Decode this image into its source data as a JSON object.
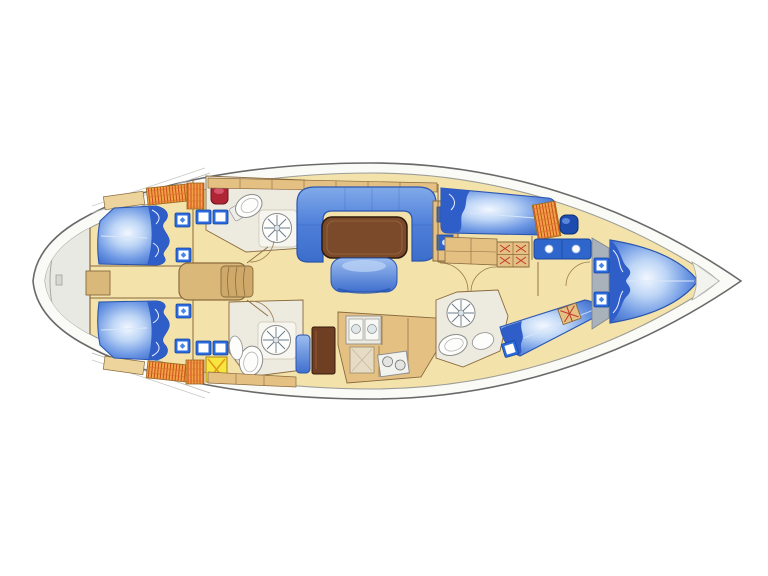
{
  "diagram": {
    "type": "yacht-interior-floor-plan",
    "view": "top-down deck plan",
    "orientation": {
      "bow": "right",
      "stern": "left"
    }
  },
  "palette": {
    "background": "#ffffff",
    "hull_deck": "#fafaf7",
    "hull_outline": "#6a6a6a",
    "inner_line": "#9c9c98",
    "platform_gray": "#e9e9e3",
    "floor": "#f3e3ab",
    "wood": "#e4c183",
    "wood_light": "#ecd49c",
    "wood_outline": "#8a6a3e",
    "upholstery_blue": "#3b6dcb",
    "upholstery_light": "#bed6f6",
    "pillow_blue": "#2f5ec9",
    "bed_stroke": "#2a55ae",
    "table_brown": "#7b4a2a",
    "fridge_brown": "#6e3f22",
    "counter_blue": "#2f66cc",
    "hatch_frame": "#2b6be0",
    "locker_orange": "#f0a446",
    "locker_hatch_red": "#cb4a1c",
    "drawer_cross_red": "#c0392b",
    "tech_yellow": "#f8e63e",
    "tech_yellow_x": "#e29a1c",
    "sink_red": "#b02535",
    "sink_navy": "#1d4cae",
    "fixture_white": "#fdfdfb",
    "fixture_outline": "#8c8c8c",
    "panel_gray": "#a9b1ba"
  },
  "areas": [
    {
      "name": "swim-platform",
      "fixtures": [
        "transom-step"
      ]
    },
    {
      "name": "aft-cabin-port",
      "fixtures": [
        "double-berth",
        "pillows",
        "deck-hatch",
        "deck-hatch",
        "locker-orange"
      ]
    },
    {
      "name": "aft-cabin-starboard",
      "fixtures": [
        "double-berth",
        "pillows",
        "deck-hatch",
        "deck-hatch",
        "locker-orange"
      ]
    },
    {
      "name": "aft-head-port",
      "fixtures": [
        "toilet",
        "shower-drain-wheel",
        "washbasin-red",
        "hatch-pair"
      ]
    },
    {
      "name": "aft-head-starboard",
      "fixtures": [
        "toilet",
        "shower-drain-wheel",
        "washbasin",
        "hatch-pair",
        "technical-locker-yellow"
      ]
    },
    {
      "name": "companionway",
      "fixtures": [
        "engine-box",
        "steps",
        "door-swings"
      ]
    },
    {
      "name": "saloon",
      "fixtures": [
        "u-shaped-settee",
        "dining-table",
        "stool",
        "sideboard-screens",
        "shelf-rail"
      ]
    },
    {
      "name": "galley",
      "fixtures": [
        "double-sink",
        "cabinet",
        "stove-two-burner",
        "refrigerator-brown",
        "locker-blue"
      ]
    },
    {
      "name": "corridor",
      "fixtures": [
        "drawer-unit-cross-hatch",
        "door-swings"
      ]
    },
    {
      "name": "forward-cabin-port",
      "fixtures": [
        "berth",
        "pillow",
        "shelf"
      ]
    },
    {
      "name": "forward-head-port",
      "fixtures": [
        "locker-orange",
        "washbasin-navy",
        "vanity-two-sinks"
      ]
    },
    {
      "name": "forward-head-starboard",
      "fixtures": [
        "shower-drain-wheel",
        "toilet",
        "washbasin"
      ]
    },
    {
      "name": "forward-cabin-starboard",
      "fixtures": [
        "double-berth",
        "pillow",
        "deck-hatch",
        "locker-cross-hatch"
      ]
    },
    {
      "name": "owner-cabin-bow",
      "fixtures": [
        "v-berth",
        "pillows",
        "deck-hatch",
        "deck-hatch",
        "gray-panel"
      ]
    },
    {
      "name": "anchor-locker",
      "fixtures": []
    }
  ]
}
